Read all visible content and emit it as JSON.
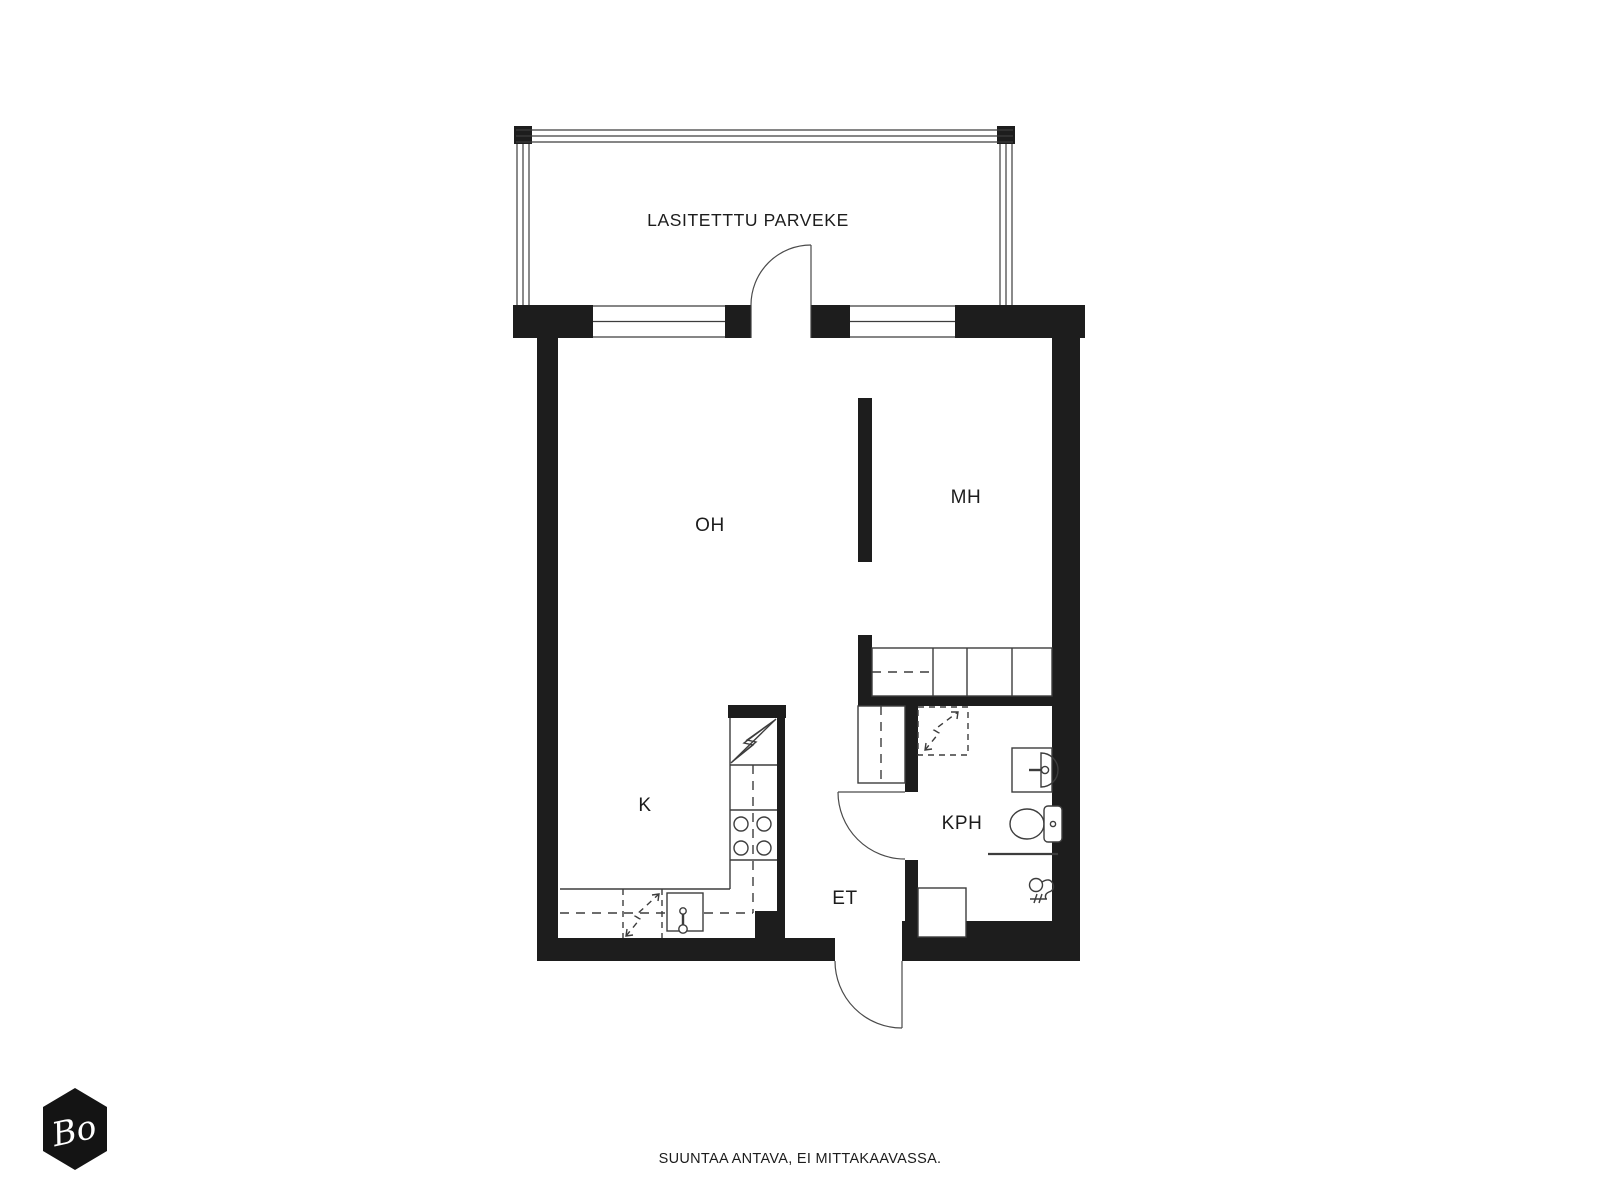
{
  "colors": {
    "background": "#ffffff",
    "wall": "#1d1d1d",
    "line": "#3d3d3d",
    "door": "#4a4a4a",
    "text": "#1c1c1c",
    "logo_bg": "#141414",
    "logo_text": "#ffffff"
  },
  "plan": {
    "balcony": {
      "label": "LASITETTTU PARVEKE"
    },
    "rooms": {
      "living_room": "OH",
      "bedroom": "MH",
      "kitchen": "K",
      "bathroom": "KPH",
      "entry": "ET"
    }
  },
  "footer": {
    "disclaimer": "SUUNTAA ANTAVA, EI MITTAKAAVASSA."
  },
  "logo": {
    "text": "Bo"
  }
}
